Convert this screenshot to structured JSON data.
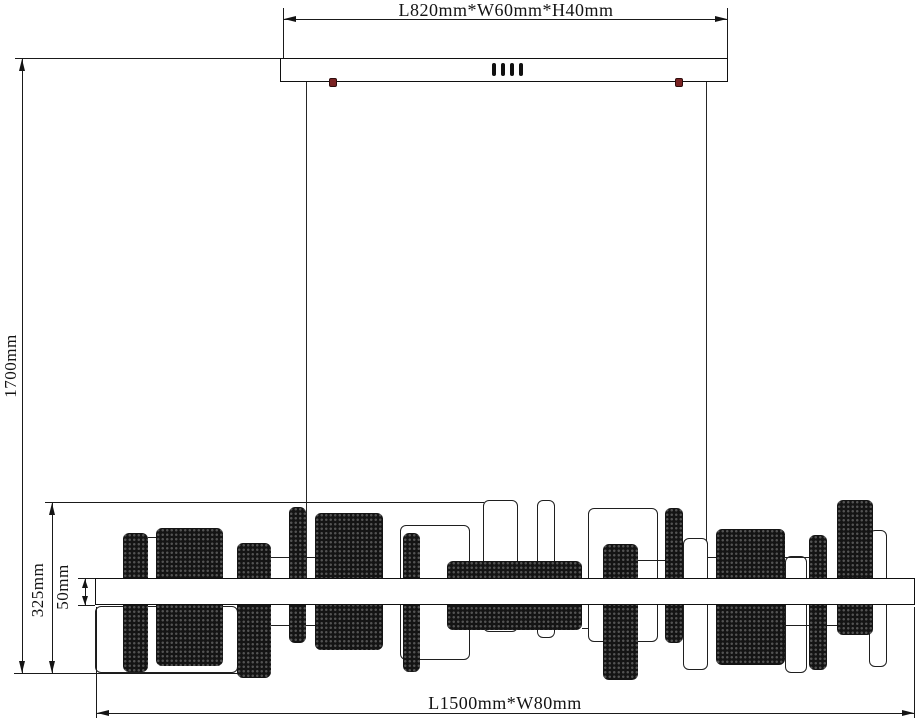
{
  "labels": {
    "canopy_dim": "L820mm*W60mm*H40mm",
    "drop_dim": "1700mm",
    "body_height_dim": "325mm",
    "bar_height_dim": "50mm",
    "body_dim": "L1500mm*W80mm"
  },
  "colors": {
    "line": "#1a1a1a",
    "panel_fill": "#141414",
    "screw": "#7a2323",
    "background": "#ffffff"
  },
  "drawing": {
    "canopy": {
      "x": 280,
      "y": 58,
      "w": 448,
      "h": 24,
      "slots": [
        {
          "x": 211
        },
        {
          "x": 220
        },
        {
          "x": 229
        },
        {
          "x": 238
        }
      ],
      "screws": [
        {
          "x": 48
        },
        {
          "x": 394
        }
      ]
    },
    "wires": [
      {
        "x": 306,
        "y1": 82,
        "y2": 578
      },
      {
        "x": 706,
        "y1": 82,
        "y2": 578
      }
    ],
    "bar": {
      "x": 95,
      "y": 578,
      "w": 820,
      "h": 27
    },
    "panels": [
      {
        "type": "outline",
        "x": 95,
        "y": 606,
        "w": 143,
        "h": 67
      },
      {
        "type": "outline",
        "x": 400,
        "y": 525,
        "w": 70,
        "h": 135
      },
      {
        "type": "outline",
        "x": 483,
        "y": 500,
        "w": 35,
        "h": 132
      },
      {
        "type": "outline",
        "x": 537,
        "y": 500,
        "w": 18,
        "h": 138
      },
      {
        "type": "outline",
        "x": 588,
        "y": 508,
        "w": 70,
        "h": 134
      },
      {
        "type": "outline",
        "x": 683,
        "y": 538,
        "w": 25,
        "h": 132
      },
      {
        "type": "outline",
        "x": 785,
        "y": 556,
        "w": 22,
        "h": 117
      },
      {
        "type": "outline",
        "x": 869,
        "y": 530,
        "w": 18,
        "h": 137
      },
      {
        "type": "solid",
        "x": 123,
        "y": 533,
        "w": 25,
        "h": 139
      },
      {
        "type": "solid",
        "x": 156,
        "y": 528,
        "w": 67,
        "h": 138
      },
      {
        "type": "solid",
        "x": 237,
        "y": 543,
        "w": 34,
        "h": 135
      },
      {
        "type": "solid",
        "x": 289,
        "y": 507,
        "w": 17,
        "h": 136
      },
      {
        "type": "solid",
        "x": 315,
        "y": 513,
        "w": 68,
        "h": 137
      },
      {
        "type": "solid",
        "x": 403,
        "y": 533,
        "w": 17,
        "h": 139
      },
      {
        "type": "solid",
        "x": 447,
        "y": 561,
        "w": 135,
        "h": 69
      },
      {
        "type": "solid",
        "x": 603,
        "y": 544,
        "w": 35,
        "h": 136
      },
      {
        "type": "solid",
        "x": 665,
        "y": 508,
        "w": 18,
        "h": 135
      },
      {
        "type": "solid",
        "x": 716,
        "y": 529,
        "w": 69,
        "h": 136
      },
      {
        "type": "solid",
        "x": 809,
        "y": 535,
        "w": 18,
        "h": 135
      },
      {
        "type": "solid",
        "x": 837,
        "y": 500,
        "w": 36,
        "h": 135
      }
    ],
    "connectors": [
      {
        "x1": 148,
        "x2": 156,
        "y": 537
      },
      {
        "x1": 271,
        "x2": 289,
        "y": 557
      },
      {
        "x1": 271,
        "x2": 289,
        "y": 625
      },
      {
        "x1": 306,
        "x2": 315,
        "y": 557
      },
      {
        "x1": 306,
        "x2": 315,
        "y": 625
      },
      {
        "x1": 638,
        "x2": 665,
        "y": 560
      },
      {
        "x1": 582,
        "x2": 588,
        "y": 628
      },
      {
        "x1": 708,
        "x2": 716,
        "y": 557
      },
      {
        "x1": 785,
        "x2": 809,
        "y": 557
      },
      {
        "x1": 785,
        "x2": 809,
        "y": 625
      },
      {
        "x1": 827,
        "x2": 837,
        "y": 625
      }
    ]
  }
}
